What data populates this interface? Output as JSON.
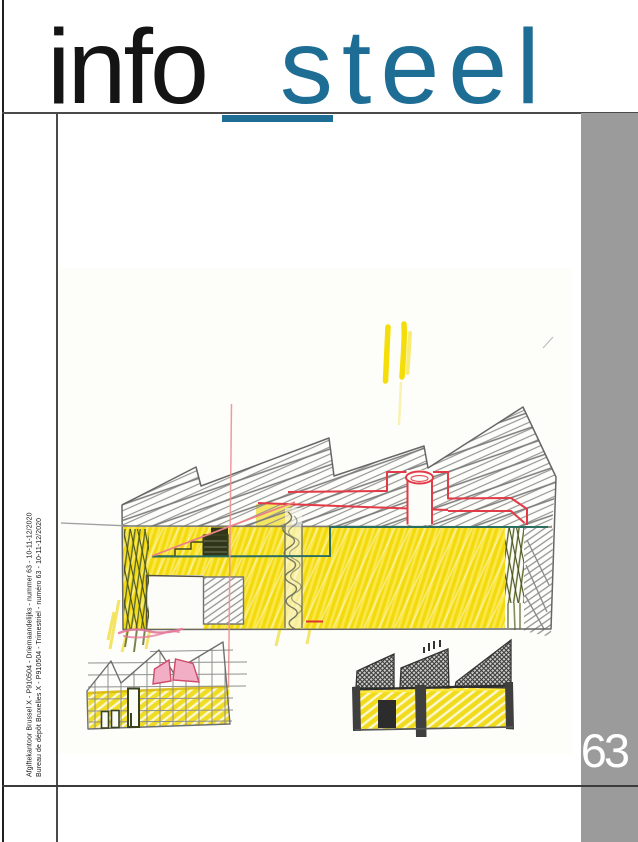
{
  "page": {
    "width": 638,
    "height": 842,
    "background": "#ffffff"
  },
  "header": {
    "title_word1": "info",
    "title_separator": "_",
    "title_word2": "steel",
    "word1_color": "#141414",
    "word2_color": "#1d6d95"
  },
  "spine": {
    "line1": "Afgiftekantoor Brussel X - P910504 - Driemaandelijks - nummer 63 - 10-11-12/2020",
    "line2": "Bureau de dépôt Bruxelles X - P910504 - Trimestriel - numéro 63 - 10-11-12/2020"
  },
  "issue_badge": {
    "number": "63",
    "background": "#9b9b9b",
    "text_color": "#ffffff"
  },
  "sketch": {
    "alt": "Hand-drawn colour-pencil sketch of industrial halls with sawtooth roofs: a large yellow hall with grey hatched roof, red rooftop duct and chimney, plus two smaller study sketches below",
    "palette": {
      "yellow": "#f3da0e",
      "pencil_grey": "#8e8e8e",
      "red": "#e23b47",
      "pink": "#ee8f93",
      "teal": "#2b6e60",
      "olive": "#5a6524",
      "dark_pencil": "#3a3a3a"
    }
  }
}
